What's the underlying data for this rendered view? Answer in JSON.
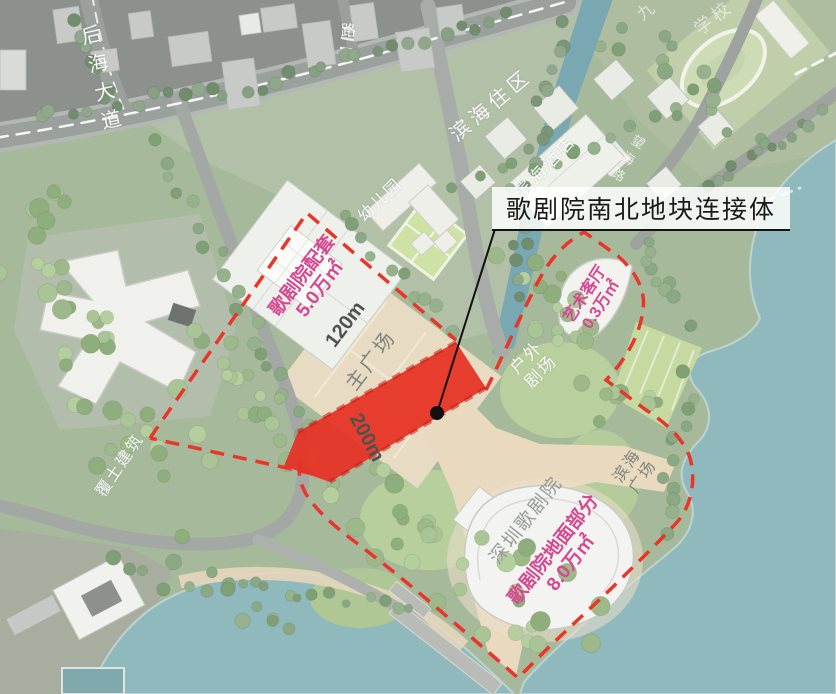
{
  "labels": {
    "houhai_avenue": "后海大道",
    "road_stub": "路",
    "jiu": "九",
    "school": "学校",
    "binhai_residential": "滨海住区",
    "binhai_hotel": "滨海酒店",
    "kindergarten": "幼儿园",
    "wanghai_road": "望海路",
    "callout": "歌剧院南北地块连接体",
    "opera_support": "歌剧院配套\n5.0万㎡",
    "dim_120": "120m",
    "main_plaza": "主广场",
    "dim_200": "200m",
    "art_living_room": "艺术客厅\n0.3万㎡",
    "outdoor_theater": "户外\n剧场",
    "binhai_plaza": "滨海\n广场",
    "shenzhen_opera_house": "深圳歌剧院",
    "opera_ground": "歌剧院地面部分\n8.0万㎡",
    "earth_sheltered_building": "覆土建筑"
  },
  "colors": {
    "boundary_red": "#e8362a",
    "connector_red": "#e63024",
    "label_pink": "#d6488f",
    "water": "#8fb9bc",
    "callout_ink": "#1a1a1a"
  }
}
